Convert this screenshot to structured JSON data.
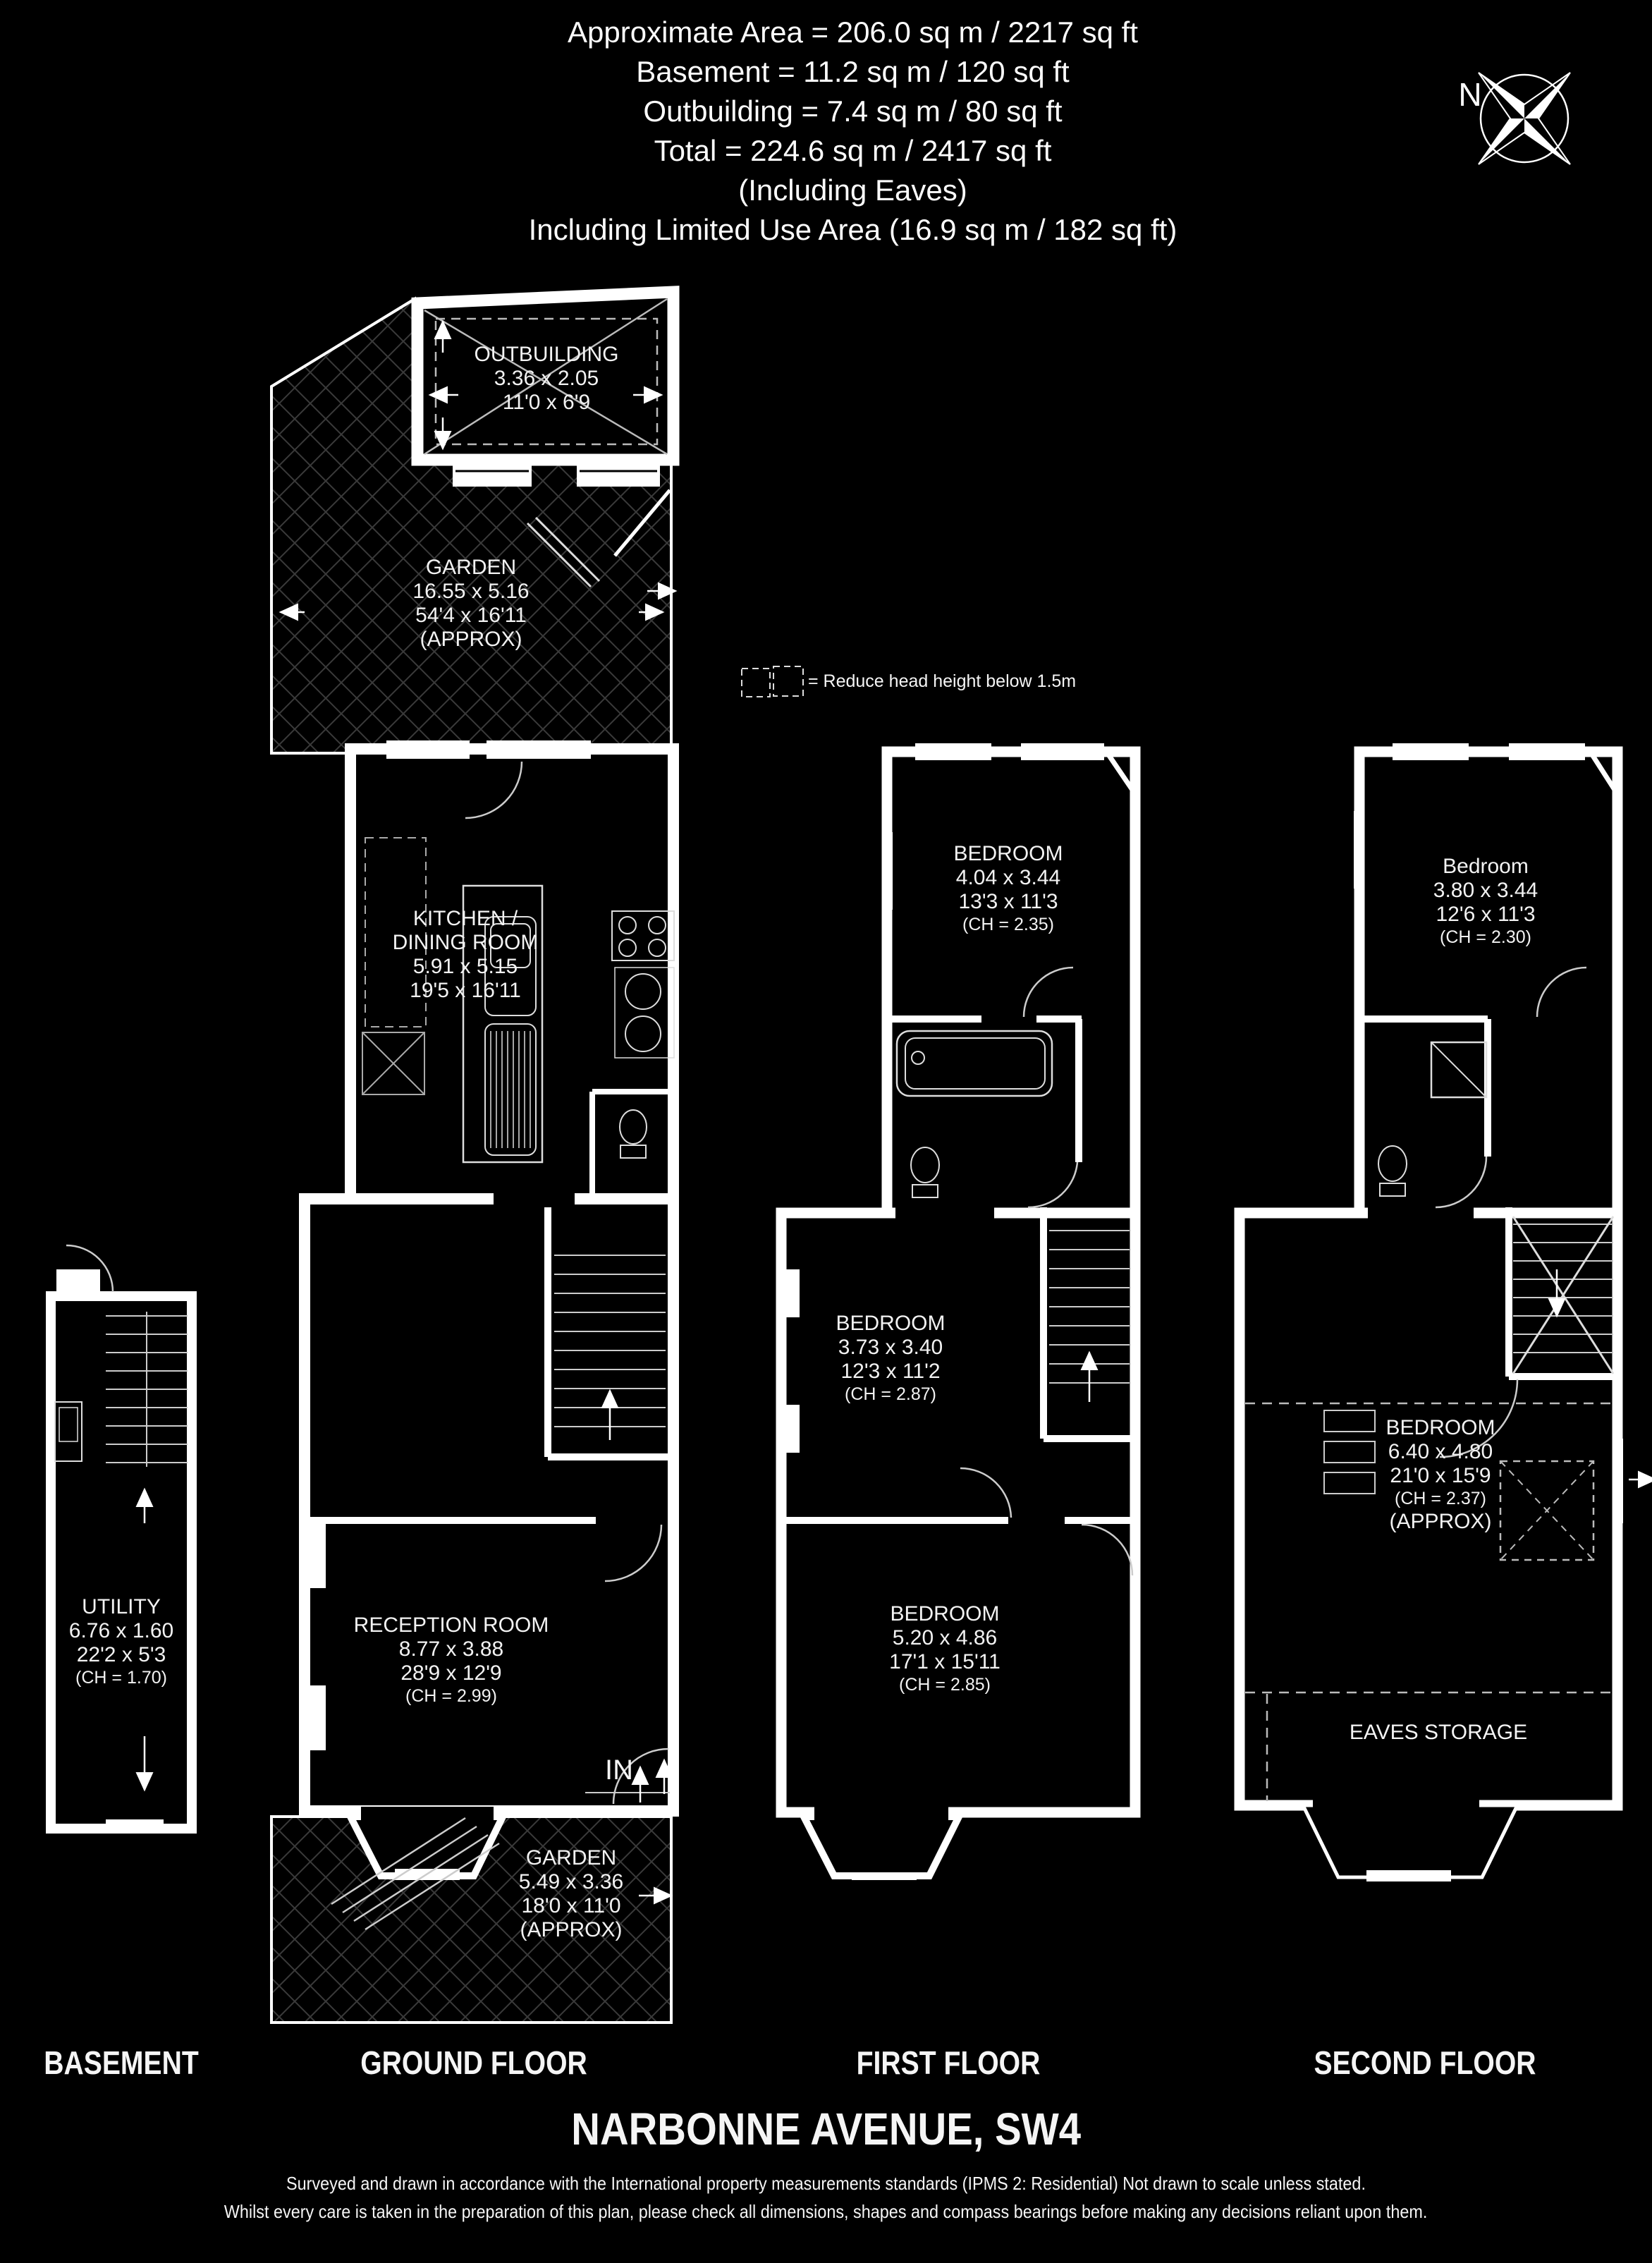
{
  "header": {
    "lines": [
      "Approximate Area = 206.0 sq m / 2217 sq ft",
      "Basement = 11.2 sq m / 120 sq ft",
      "Outbuilding = 7.4 sq m / 80 sq ft",
      "Total = 224.6 sq m / 2417 sq ft",
      "(Including Eaves)",
      "Including Limited Use Area (16.9 sq m / 182 sq ft)"
    ]
  },
  "compass": {
    "north": "N"
  },
  "legend": {
    "label": "= Reduce head height below 1.5m"
  },
  "plans": {
    "basement": {
      "floor_label": "BASEMENT",
      "utility": {
        "name": "UTILITY",
        "metric": "6.76 x 1.60",
        "imperial": "22'2 x 5'3",
        "ch": "(CH = 1.70)"
      }
    },
    "ground": {
      "floor_label": "GROUND FLOOR",
      "outbuilding": {
        "name": "OUTBUILDING",
        "metric": "3.36 x 2.05",
        "imperial": "11'0 x 6'9"
      },
      "garden_rear": {
        "name": "GARDEN",
        "metric": "16.55 x 5.16",
        "imperial": "54'4 x 16'11",
        "note": "(APPROX)"
      },
      "kitchen": {
        "name_line1": "KITCHEN /",
        "name_line2": "DINING ROOM",
        "metric": "5.91 x 5.15",
        "imperial": "19'5 x 16'11"
      },
      "reception": {
        "name": "RECEPTION ROOM",
        "metric": "8.77 x 3.88",
        "imperial": "28'9 x 12'9",
        "ch": "(CH = 2.99)"
      },
      "garden_front": {
        "name": "GARDEN",
        "metric": "5.49 x 3.36",
        "imperial": "18'0 x 11'0",
        "note": "(APPROX)"
      },
      "entrance_label": "IN"
    },
    "first": {
      "floor_label": "FIRST FLOOR",
      "bedroom_rear": {
        "name": "BEDROOM",
        "metric": "4.04 x 3.44",
        "imperial": "13'3 x 11'3",
        "ch": "(CH = 2.35)"
      },
      "bedroom_middle": {
        "name": "BEDROOM",
        "metric": "3.73 x 3.40",
        "imperial": "12'3 x 11'2",
        "ch": "(CH = 2.87)"
      },
      "bedroom_front": {
        "name": "BEDROOM",
        "metric": "5.20 x 4.86",
        "imperial": "17'1 x 15'11",
        "ch": "(CH = 2.85)"
      }
    },
    "second": {
      "floor_label": "SECOND FLOOR",
      "bedroom_rear": {
        "name": "Bedroom",
        "metric": "3.80 x 3.44",
        "imperial": "12'6 x 11'3",
        "ch": "(CH = 2.30)"
      },
      "bedroom_main": {
        "name": "BEDROOM",
        "metric": "6.40 x 4.80",
        "imperial": "21'0 x 15'9",
        "ch": "(CH = 2.37)",
        "note": "(APPROX)"
      },
      "eaves_label": "EAVES STORAGE"
    }
  },
  "title": "NARBONNE AVENUE, SW4",
  "footer": {
    "lines": [
      "Surveyed and drawn in accordance with the International property measurements standards (IPMS 2: Residential) Not drawn to scale unless stated.",
      "Whilst every care is taken in the preparation of this plan, please check all dimensions, shapes and compass bearings before making any decisions reliant upon them."
    ]
  },
  "colors": {
    "background": "#000000",
    "line": "#ffffff",
    "hatch": "#3a3a3a"
  }
}
